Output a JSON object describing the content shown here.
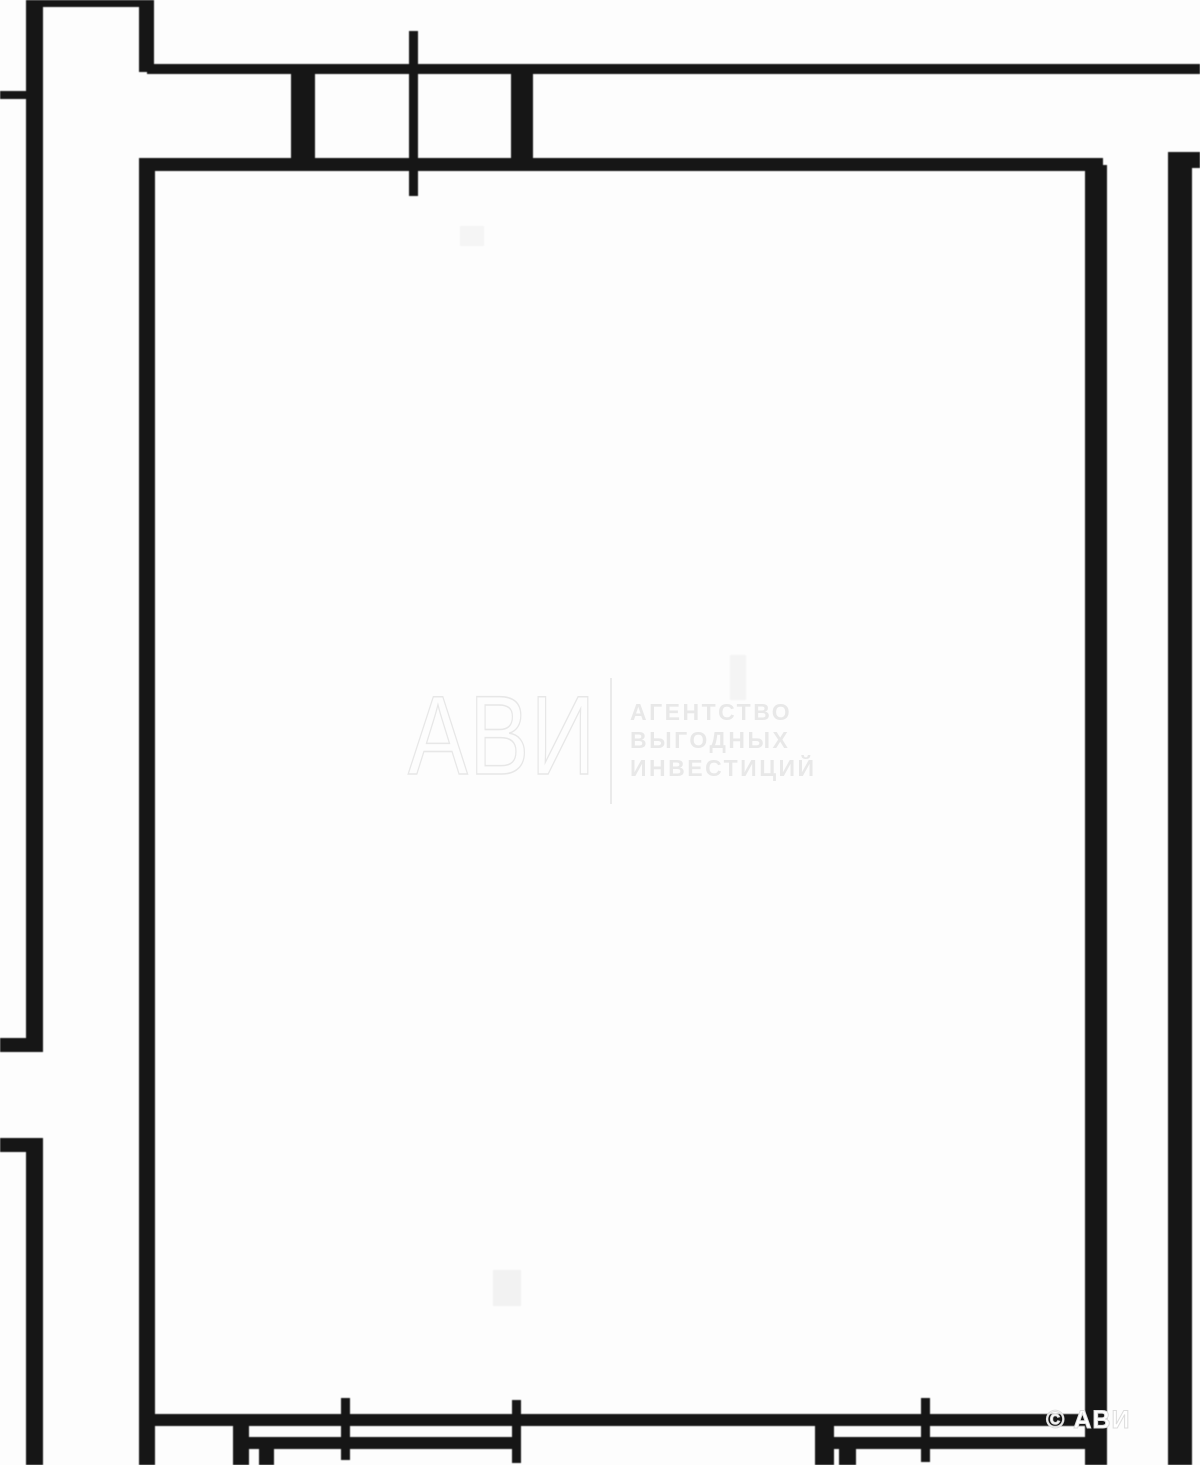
{
  "page": {
    "width": 1200,
    "height": 1465,
    "background": "#fdfdfd"
  },
  "watermark": {
    "logo": "АВИ",
    "tagline": [
      "АГЕНТСТВО",
      "ВЫГОДНЫХ",
      "ИНВЕСТИЦИЙ"
    ],
    "color": "#e8e8e8"
  },
  "copyright": {
    "text": "© АВИ",
    "color": "#ffffff"
  },
  "floorplan": {
    "wall_color": "#161616",
    "artifact_color": "#f3f3f3",
    "segments": [
      {
        "name": "outer-left-wall-upper",
        "x": 26,
        "y": 0,
        "w": 17,
        "h": 1044
      },
      {
        "name": "outer-left-wall-lower",
        "x": 26,
        "y": 1146,
        "w": 17,
        "h": 319
      },
      {
        "name": "outer-left-door-stub-top",
        "x": 0,
        "y": 1038,
        "w": 43,
        "h": 14
      },
      {
        "name": "outer-left-door-stub-bottom",
        "x": 0,
        "y": 1138,
        "w": 43,
        "h": 14
      },
      {
        "name": "outer-left-tick",
        "x": 0,
        "y": 91,
        "w": 27,
        "h": 8
      },
      {
        "name": "top-edge-wall",
        "x": 36,
        "y": 0,
        "w": 112,
        "h": 7
      },
      {
        "name": "upper-left-stub-wall",
        "x": 139,
        "y": 0,
        "w": 15,
        "h": 72
      },
      {
        "name": "top-wall-outer-line",
        "x": 147,
        "y": 64,
        "w": 1053,
        "h": 10
      },
      {
        "name": "top-wall-inner-line",
        "x": 139,
        "y": 158,
        "w": 964,
        "h": 13
      },
      {
        "name": "top-wall-pier-left",
        "x": 291,
        "y": 71,
        "w": 24,
        "h": 92
      },
      {
        "name": "top-wall-pier-right",
        "x": 511,
        "y": 69,
        "w": 22,
        "h": 94
      },
      {
        "name": "top-window-tick",
        "x": 409,
        "y": 31,
        "w": 9,
        "h": 165
      },
      {
        "name": "room-left-wall",
        "x": 139,
        "y": 158,
        "w": 16,
        "h": 1307
      },
      {
        "name": "room-right-wall",
        "x": 1085,
        "y": 165,
        "w": 22,
        "h": 1300
      },
      {
        "name": "outer-right-wall",
        "x": 1168,
        "y": 152,
        "w": 24,
        "h": 1313
      },
      {
        "name": "outer-right-top-stub",
        "x": 1168,
        "y": 152,
        "w": 32,
        "h": 16
      },
      {
        "name": "bottom-wall-inner-line",
        "x": 147,
        "y": 1414,
        "w": 949,
        "h": 12
      },
      {
        "name": "bottom-wall-outer-line-left",
        "x": 233,
        "y": 1437,
        "w": 285,
        "h": 12
      },
      {
        "name": "bottom-wall-outer-line-right",
        "x": 820,
        "y": 1437,
        "w": 276,
        "h": 12
      },
      {
        "name": "bottom-door-jamb-1",
        "x": 233,
        "y": 1414,
        "w": 16,
        "h": 51
      },
      {
        "name": "bottom-door-jamb-2",
        "x": 259,
        "y": 1437,
        "w": 15,
        "h": 28
      },
      {
        "name": "bottom-door-jamb-3",
        "x": 815,
        "y": 1414,
        "w": 19,
        "h": 51
      },
      {
        "name": "bottom-door-jamb-4",
        "x": 839,
        "y": 1437,
        "w": 17,
        "h": 28
      },
      {
        "name": "bottom-window-tick-1",
        "x": 341,
        "y": 1398,
        "w": 9,
        "h": 62
      },
      {
        "name": "bottom-window-tick-2",
        "x": 512,
        "y": 1400,
        "w": 9,
        "h": 63
      },
      {
        "name": "bottom-window-tick-3",
        "x": 921,
        "y": 1398,
        "w": 9,
        "h": 64
      },
      {
        "name": "artifact-smudge-1",
        "x": 493,
        "y": 1270,
        "w": 28,
        "h": 36,
        "color": "#f2f2f2"
      },
      {
        "name": "artifact-smudge-2",
        "x": 460,
        "y": 226,
        "w": 24,
        "h": 20,
        "color": "#f5f5f5"
      },
      {
        "name": "artifact-smudge-3",
        "x": 730,
        "y": 655,
        "w": 16,
        "h": 45,
        "color": "#f4f4f4"
      }
    ]
  }
}
